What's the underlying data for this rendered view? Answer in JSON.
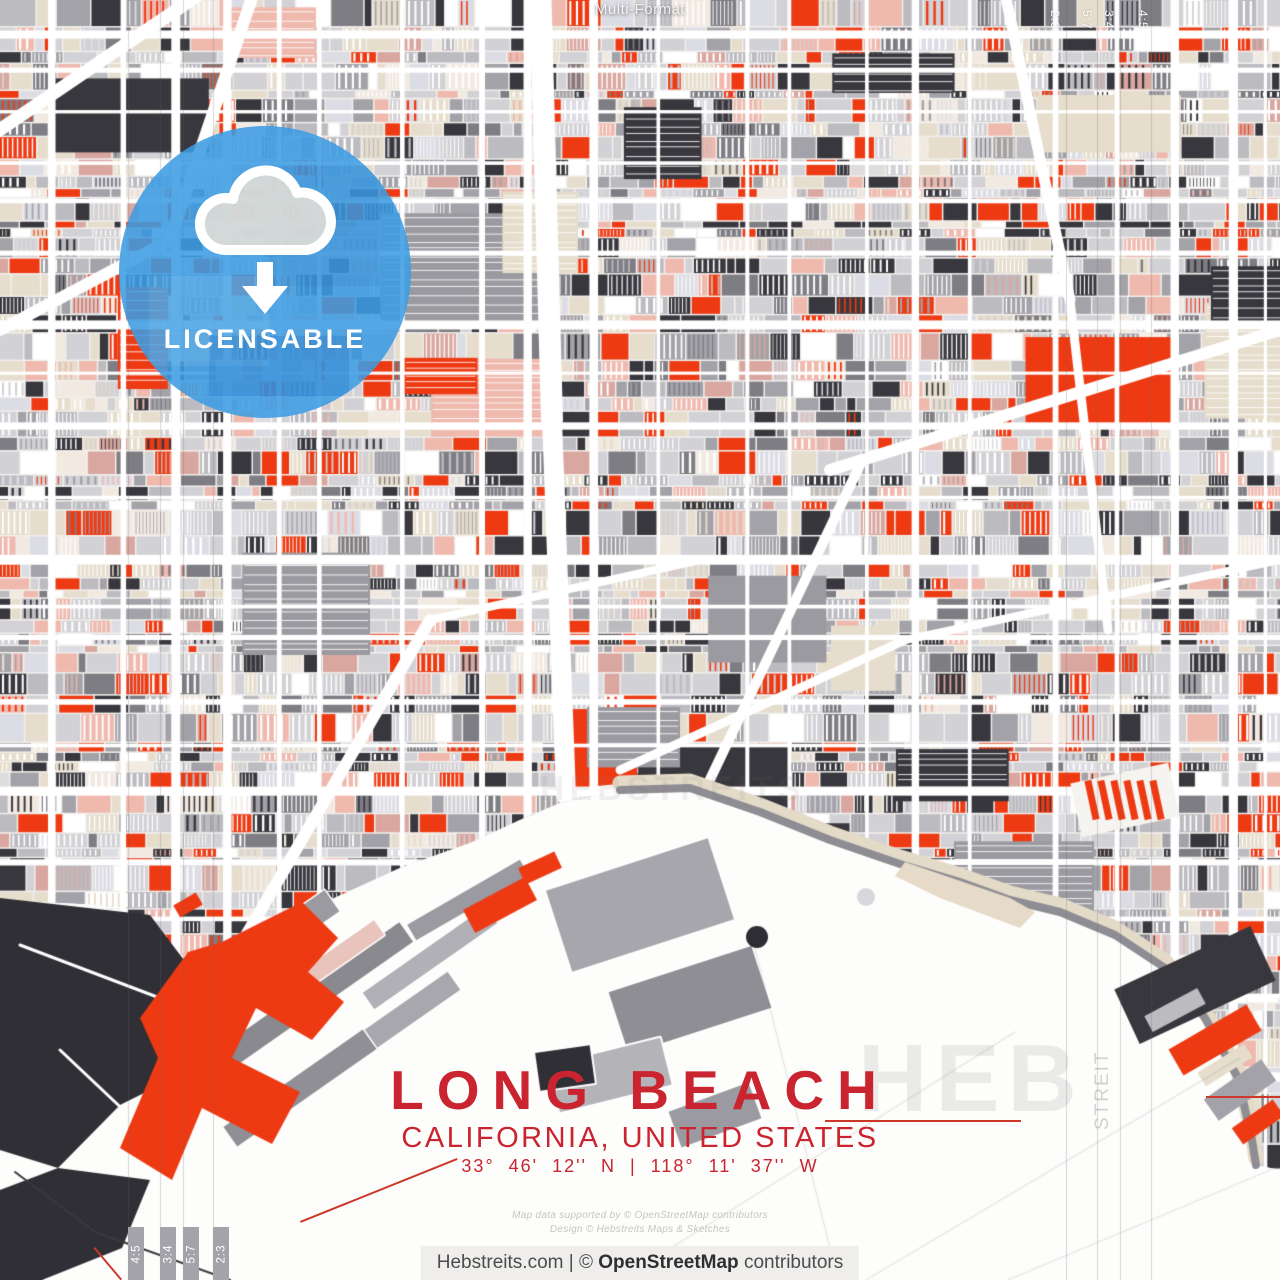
{
  "artwork": {
    "format_label": "Multi-Format",
    "title": "LONG BEACH",
    "subtitle": "CALIFORNIA, UNITED STATES",
    "coordinates": "33° 46' 12'' N | 118° 11' 37'' W"
  },
  "badge": {
    "label": "LICENSABLE",
    "icon": "cloud-download-icon"
  },
  "watermarks": {
    "brand_large": "HEB",
    "brand_vertical": "STREIT",
    "brand_center": "HEBSTREITS"
  },
  "fine_print": {
    "line1": "Map data supported by © OpenStreetMap contributors",
    "line2": "Design © Hebstreits Maps & Sketches"
  },
  "footer": {
    "site": "Hebstreits.com",
    "separator": "|",
    "copyright_symbol": "©",
    "brand": "OpenStreetMap",
    "suffix": "contributors"
  },
  "format_markers": {
    "top": [
      "2:3",
      "5:7",
      "3:4",
      "4:5"
    ],
    "bottom": [
      "4:5",
      "3:4",
      "5:7",
      "2:3"
    ]
  },
  "colors": {
    "accent_red": "#c9242f",
    "map_red": "#ee3a13",
    "badge_blue": "#3c9ce2",
    "charcoal": "#36353b",
    "beige": "#e6ddcc",
    "pink": "#efb9ae",
    "water": "#fdfdfc",
    "footer_bg": "#efeeec"
  }
}
